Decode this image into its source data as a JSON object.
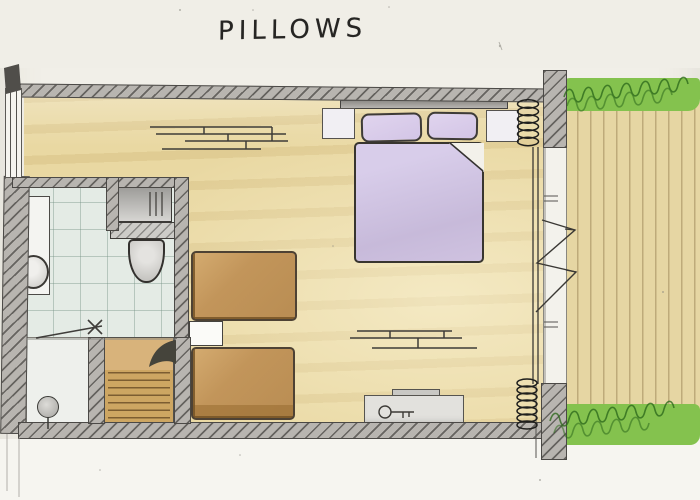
{
  "title": "PILLOWS",
  "palette": {
    "paper": "#f1efe8",
    "bedroom_floor": "#e9d8a2",
    "terrace_deck": "#e6d6a3",
    "bathroom_tile": "#e4ebe5",
    "wall_gray": "#b8b5b0",
    "duvet_lavender": "#cfc2e0",
    "pillow_lavender": "#dbcfe9",
    "twin_bed_wood": "#c2955a",
    "stairs_wood": "#cda662",
    "hedge_green": "#84c24e",
    "ink": "#3e3c38"
  },
  "plan": {
    "drawing_style": "hand-drawn watercolor floor plan sketch",
    "symbols": [
      "double-bed with two pillows and folded duvet",
      "nightstand x2 beside double bed",
      "twin bed x2 with small table between",
      "sideboard with key symbol",
      "wall shelf marks x2",
      "toilet with cistern",
      "vanity with round basin",
      "tiled bathroom floor",
      "entry with door knob symbol",
      "stairs",
      "sliding glass door with opening arrows",
      "curtain coil x2",
      "left wall window",
      "terrace decking",
      "hedge x2"
    ]
  }
}
